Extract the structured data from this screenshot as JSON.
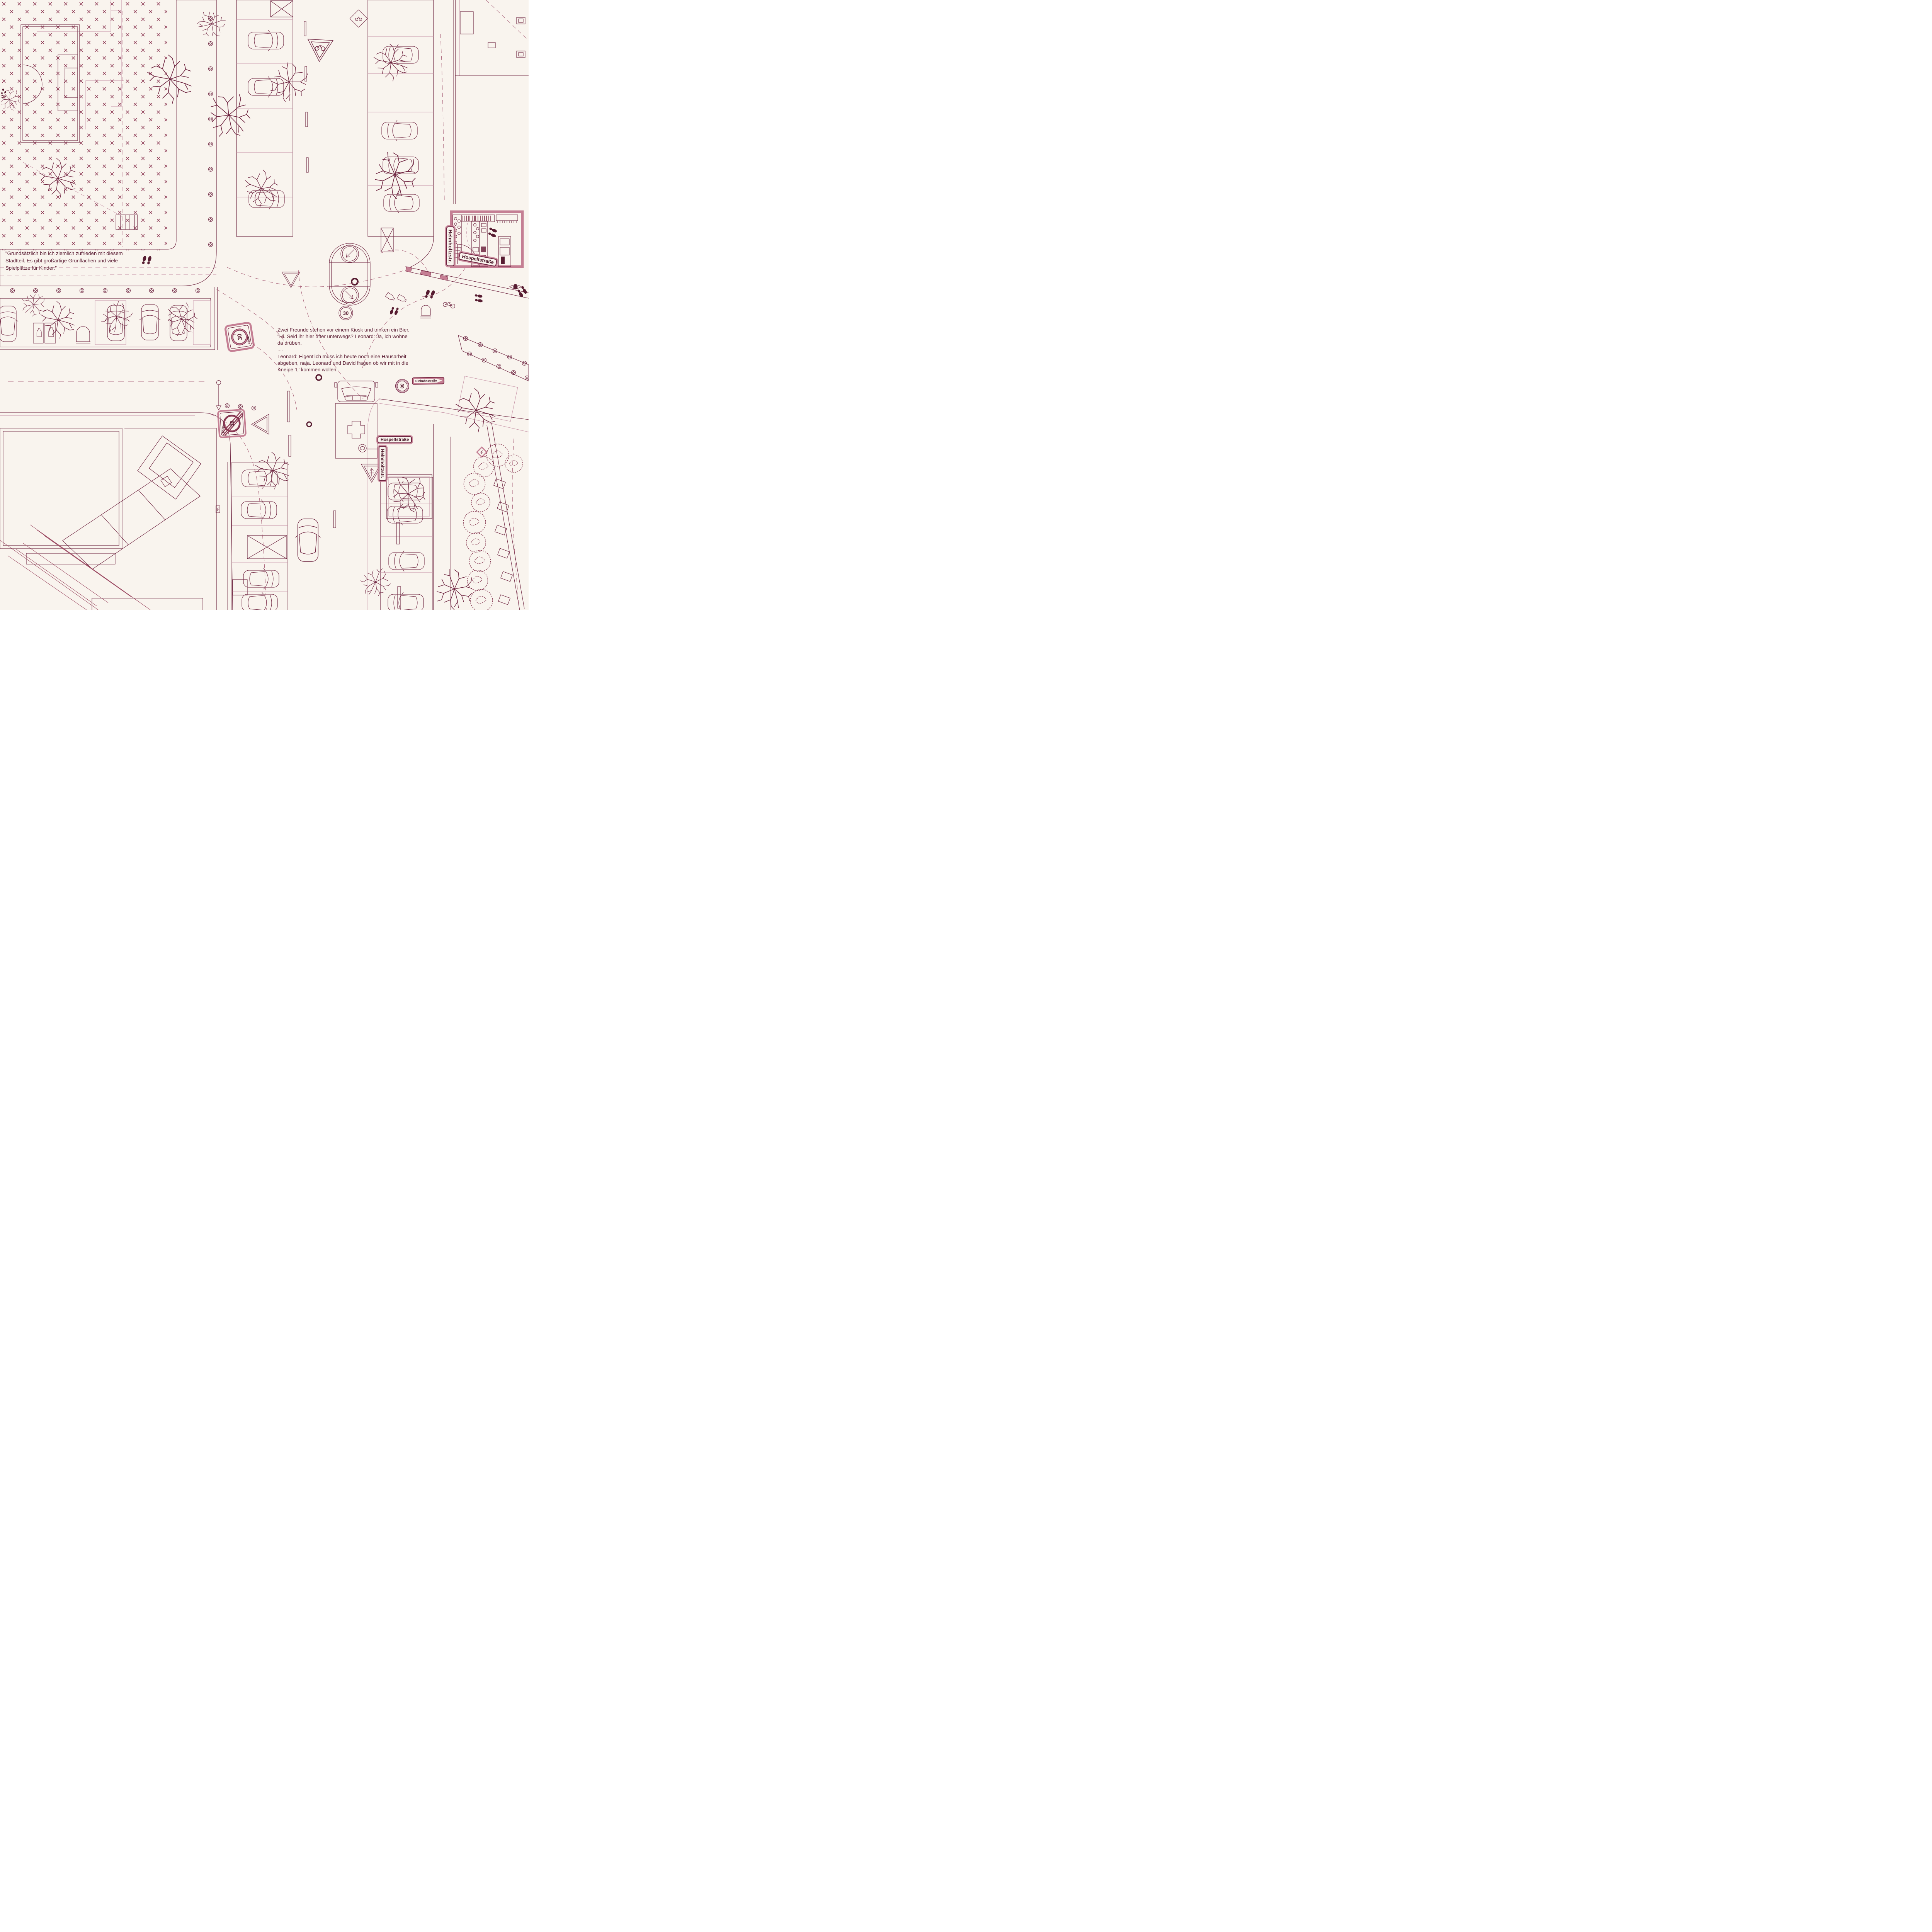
{
  "colors": {
    "background": "#f9f4ee",
    "line_dark": "#6e2440",
    "line_mid": "#a65d75",
    "line_light": "#c795a8",
    "fill_pink": "#c57f94",
    "fill_dark": "#571c31",
    "text": "#5d2036"
  },
  "annotations": {
    "quote_nw": "\"Grundsätzlich bin ich ziemlich zufrieden mit diesem\nStadtteil. Es gibt großartige Grünflächen und viele\nSpielplätze für Kinder.\"",
    "kiosk_story": "Zwei Freunde stehen vor einem Kiosk und trinken ein Bier.\n\"Hi. Seid ihr hier öfter unterwegs? Leonard: Ja, ich wohne\nda drüben.\n....\nLeonard: Eigentlich muss ich heute noch eine Hausarbeit\nabgeben, naja. Leonard und David fragen ob wir  mit in die\nKneipe 'L' kommen wollen."
  },
  "street_labels": {
    "helmholtz_north": "Helmholtzstr.",
    "hospelt_north": "Hospeltstraße",
    "einbahn": "Einbahnstraße",
    "hospelt_center": "Hospeltstraße",
    "helmholtz_center": "Helmholtzstr."
  },
  "signs": {
    "zone30_entry": {
      "number": "30",
      "word": "ZONE"
    },
    "zone30_exit": {
      "number": "30",
      "word": "ZONE"
    },
    "island_speed_circle": {
      "number": "30"
    },
    "east_speed_circle": {
      "number": "30"
    }
  },
  "icons": {
    "yield-icon": "give-way triangle",
    "priority-road-arrow-icon": "arrow crossing sign",
    "keep-side-arrow-icon": "diagonal arrow in circle",
    "medical-cross-icon": "ambulance cross",
    "bicycle-icon": "bicycle",
    "lightning-icon": "electric bolt",
    "eye-icon": "eye",
    "footprints-icon": "footprints",
    "bottle-icon": "bottle",
    "tree-icon": "bare tree",
    "bush-icon": "shrub",
    "bollard-icon": "bollard",
    "streetlamp-icon": "street lamp"
  }
}
